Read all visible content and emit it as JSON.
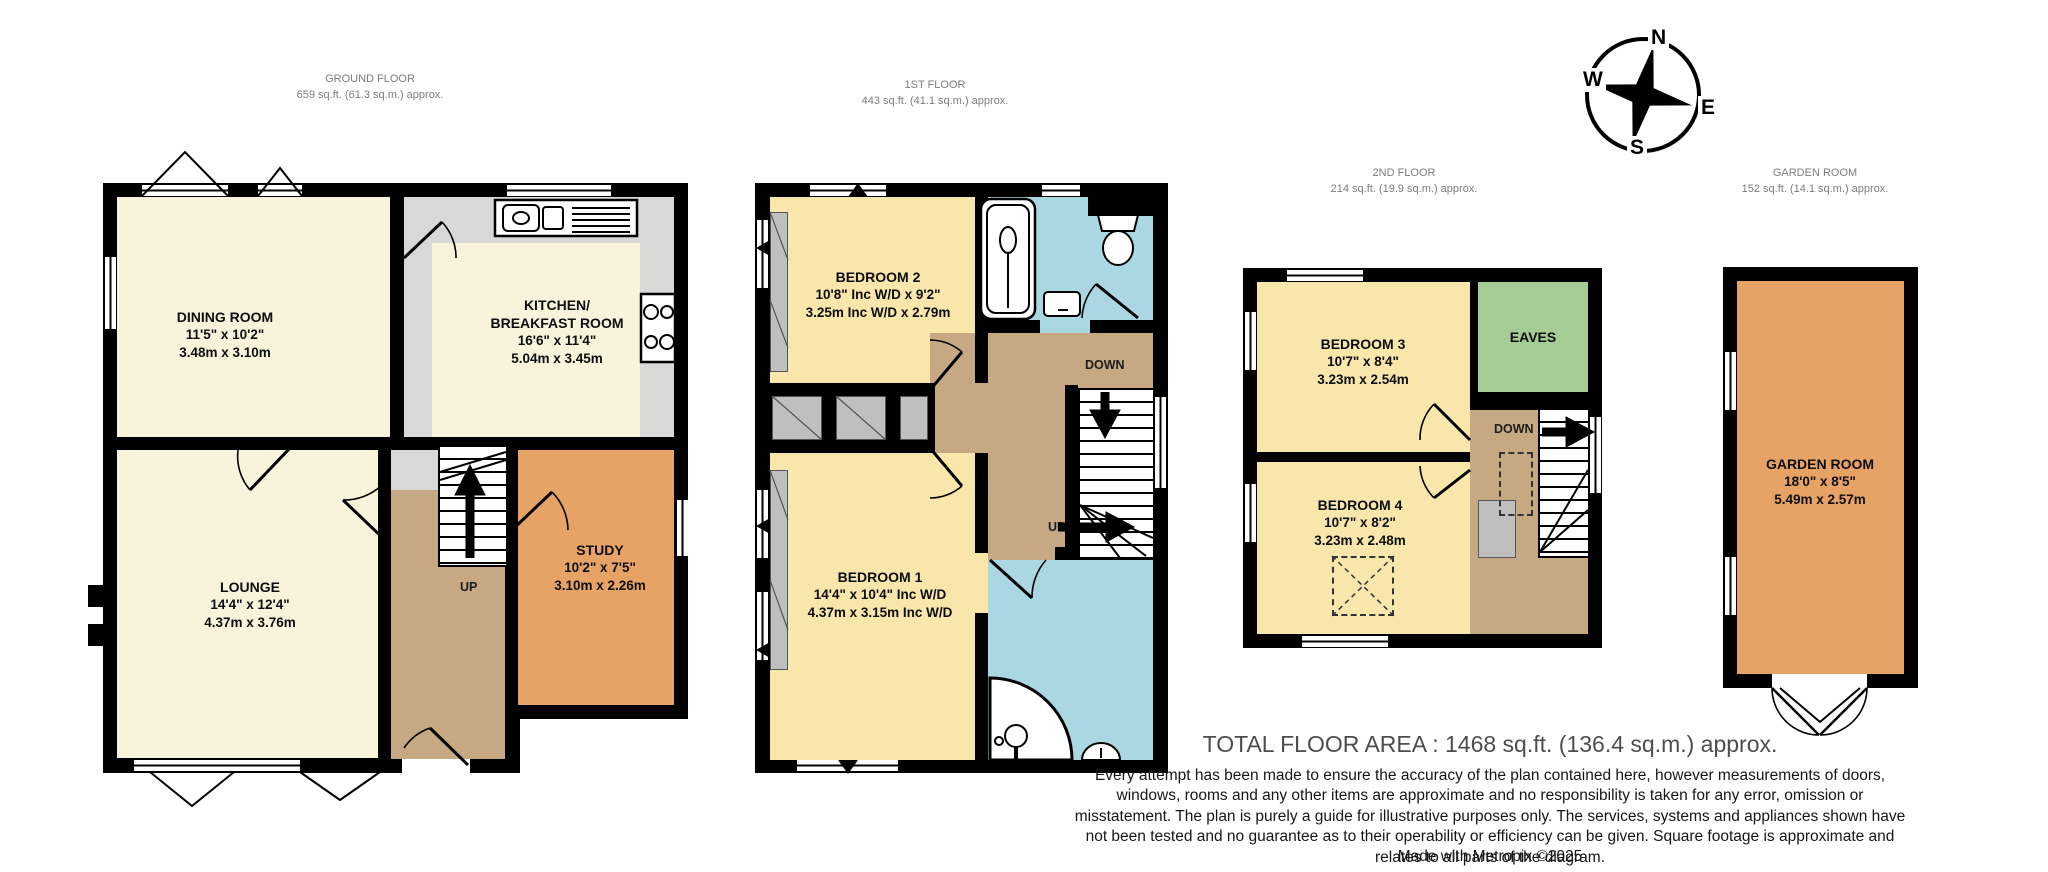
{
  "page": {
    "total_area": "TOTAL FLOOR AREA : 1468 sq.ft. (136.4 sq.m.) approx.",
    "disclaimer": "Every attempt has been made to ensure the accuracy of the plan contained here, however measurements of doors, windows, rooms and any other items are approximate and no responsibility is taken for any error, omission or misstatement. The plan is purely a guide for illustrative purposes only. The services, systems and appliances shown have not been tested and no guarantee as to their operability or efficiency can be given. Square footage is approximate and relates to all parts of the diagram.",
    "credit": "Made with Metropix ©2025"
  },
  "compass": {
    "north": "N",
    "east": "E",
    "south": "S",
    "west": "W"
  },
  "stairs": {
    "up": "UP",
    "down": "DOWN"
  },
  "floors": {
    "ground": {
      "title": "GROUND FLOOR",
      "area": "659 sq.ft. (61.3 sq.m.) approx.",
      "rooms": {
        "dining": {
          "name": "DINING ROOM",
          "imperial": "11'5\"  x 10'2\"",
          "metric": "3.48m  x 3.10m"
        },
        "kitchen": {
          "name": "KITCHEN/\nBREAKFAST ROOM",
          "imperial": "16'6\"  x 11'4\"",
          "metric": "5.04m  x 3.45m"
        },
        "lounge": {
          "name": "LOUNGE",
          "imperial": "14'4\"  x 12'4\"",
          "metric": "4.37m  x 3.76m"
        },
        "study": {
          "name": "STUDY",
          "imperial": "10'2\"  x 7'5\"",
          "metric": "3.10m  x 2.26m"
        }
      }
    },
    "first": {
      "title": "1ST FLOOR",
      "area": "443 sq.ft. (41.1 sq.m.) approx.",
      "rooms": {
        "bedroom2": {
          "name": "BEDROOM 2",
          "imperial": "10'8\" Inc W/D x 9'2\"",
          "metric": "3.25m Inc W/D x 2.79m"
        },
        "bedroom1": {
          "name": "BEDROOM 1",
          "imperial": "14'4\"  x 10'4\" Inc W/D",
          "metric": "4.37m  x 3.15m Inc W/D"
        }
      }
    },
    "second": {
      "title": "2ND FLOOR",
      "area": "214 sq.ft. (19.9 sq.m.) approx.",
      "rooms": {
        "bedroom3": {
          "name": "BEDROOM 3",
          "imperial": "10'7\"  x 8'4\"",
          "metric": "3.23m  x 2.54m"
        },
        "bedroom4": {
          "name": "BEDROOM 4",
          "imperial": "10'7\"  x 8'2\"",
          "metric": "3.23m  x 2.48m"
        },
        "eaves": {
          "name": "EAVES"
        }
      }
    },
    "garden": {
      "title": "GARDEN ROOM",
      "area": "152 sq.ft. (14.1 sq.m.) approx.",
      "rooms": {
        "garden_room": {
          "name": "GARDEN ROOM",
          "imperial": "18'0\"  x 8'5\"",
          "metric": "5.49m  x 2.57m"
        }
      }
    }
  },
  "colors": {
    "wall": "#000000",
    "cream": "#faf3dc",
    "bedroom_yellow": "#f8e6ab",
    "bathroom_blue": "#abd7e2",
    "hall_tan": "#c6a982",
    "study_orange": "#e7a366",
    "eaves_green": "#a6cc95",
    "kitchen_gray": "#d8d8d8",
    "wardrobe_gray": "#bfbfbf"
  },
  "icons": {
    "compass_rose": "compass-rose-icon",
    "sink": "kitchen-sink-icon",
    "hob": "hob-icon",
    "bathtub": "bathtub-icon",
    "toilet": "toilet-icon",
    "basin": "basin-icon",
    "shower": "shower-icon"
  }
}
